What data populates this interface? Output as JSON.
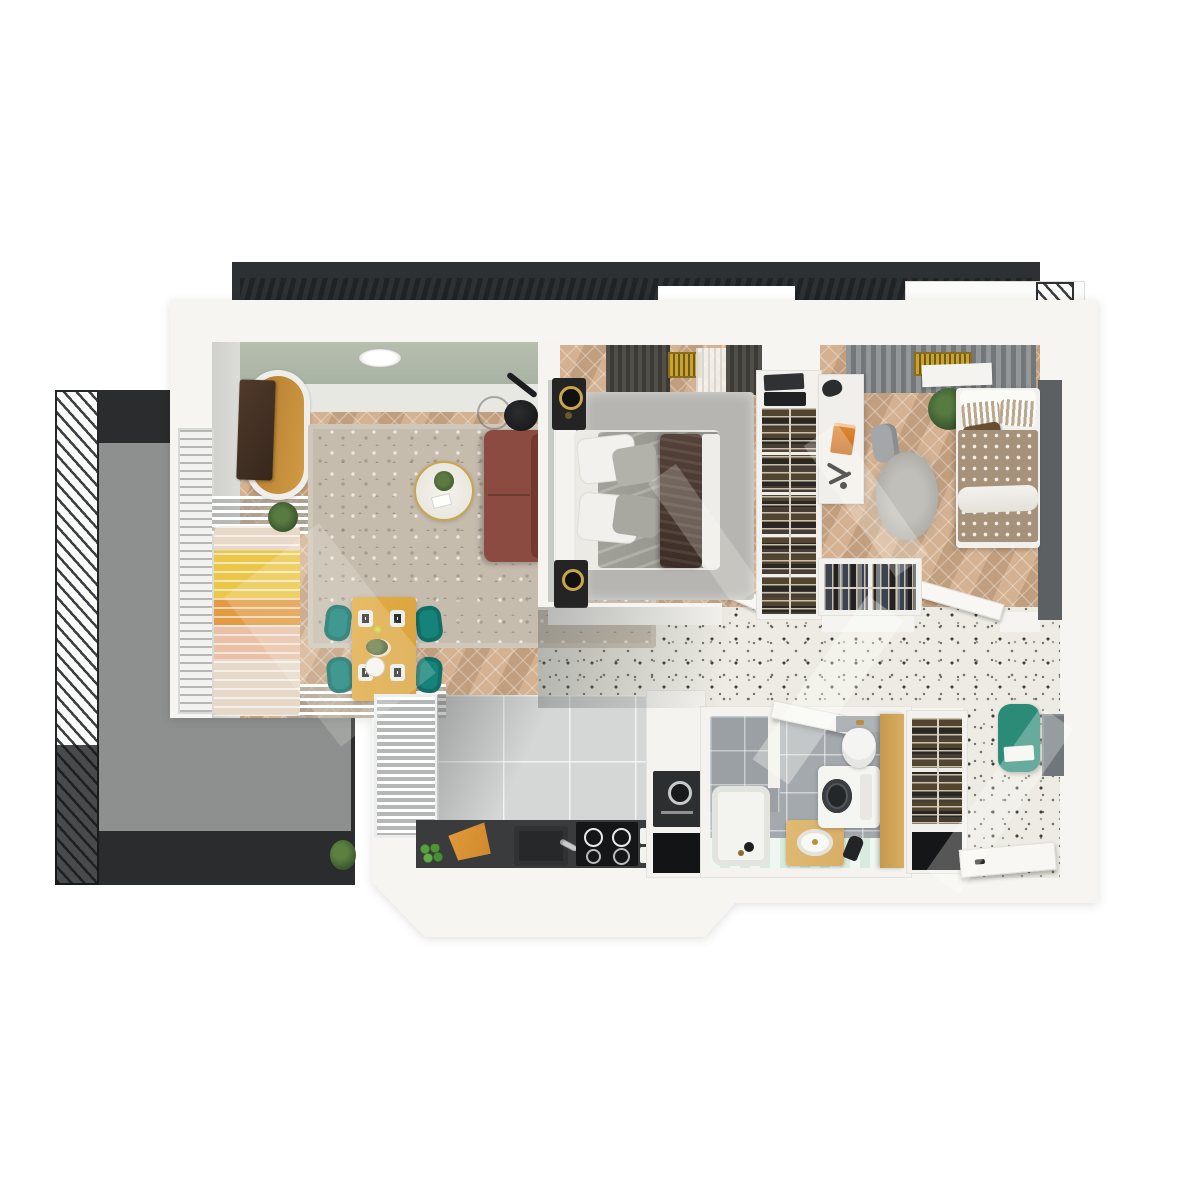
{
  "meta": {
    "title": "Top-down 3D apartment floor plan render",
    "view": "bird's-eye axonometric",
    "style": "photorealistic architectural visualization, no text labels"
  },
  "palette": {
    "paper": "#ffffff",
    "slabWhite": "#f6f5f2",
    "pergola": "#2d3134",
    "pergolaSlat": "#1f2326",
    "railWhite": "#fbfbfa",
    "railLine": "#3a3e40",
    "balconyDark": "#2a2c2d",
    "balconySlab": "#8e908f",
    "greenWall": "#a9b3a3",
    "wallFace": "#d6d7d3",
    "woodA": "#d3b191",
    "woodB": "#c19e7d",
    "rugBeige": "#c6bcae",
    "sofa": "#8c4b41",
    "sofaDark": "#73392f",
    "tableWood": "#d9a33f",
    "chairTeal": "#16837a",
    "gold": "#c9a54b",
    "lampBlack": "#1c1d1e",
    "plantGreen": "#4f6b3e",
    "bedRugGray": "#b6b5b1",
    "mattress": "#eceae5",
    "beddingGray": "#98978f",
    "throwBrown": "#4e3b32",
    "nightBlack": "#242424",
    "curtainA": "#504f49",
    "curtainB": "#3b3a35",
    "radiatorYellow": "#e5bf41",
    "wardrobeFrame": "#f2f1ed",
    "wardrobeDark": "#27221d",
    "deskWhite": "#f0efeb",
    "chairGray": "#a4a7a9",
    "duvetTaupe": "#a6917b",
    "duvetDot": "#f3ece1",
    "cushionBrown": "#5f482c",
    "accentDarkWall": "#5c6063",
    "terrazzoBase": "#edebe3",
    "speckDark": "#3e403a",
    "tileGray": "#d5d6d6",
    "counterDark": "#3a3b3d",
    "hobBlack": "#141618",
    "boardOrange": "#d08a2e",
    "appleGreen": "#55a238",
    "steel": "#c8cbcd",
    "ovenDark": "#2c2e30",
    "bathTile": "#a3a9ad",
    "bathFloorA": "#eef7f0",
    "bathFloorB": "#d9ebdd",
    "vanityWood": "#d8ae65",
    "cabinetYellow": "#d8ad62",
    "benchTeal": "#2b8b77",
    "mirrorGray": "#70767a",
    "doorWhite": "#f8f7f4"
  },
  "rooms": [
    {
      "id": "living-room",
      "label": "Living room",
      "floor": "herringbone oak",
      "furniture": [
        "wood-and-white TV sideboard",
        "wall TV panel",
        "arc floor lamp with glass globe",
        "terracotta two-seat sofa",
        "round white coffee table with plant",
        "mottled beige area rug",
        "window daybed with yellow-orange striped blanket",
        "potted plant",
        "round ceiling light",
        "slatted white radiator benches",
        "sage green feature wall"
      ]
    },
    {
      "id": "dining-area",
      "label": "Dining area",
      "furniture": [
        "rectangular wooden dining table",
        "four teal chairs",
        "two place settings per side",
        "carafe",
        "flower centerpiece",
        "round serving plate"
      ]
    },
    {
      "id": "master-bedroom",
      "label": "Master bedroom",
      "furniture": [
        "double bed with gray bedding and dark brown throw",
        "white pillows",
        "light gray rug",
        "two black nightstand speakers with brass rings",
        "dark pleated curtains",
        "yellow striped radiator",
        "sheer curtain",
        "open white door"
      ]
    },
    {
      "id": "kids-bedroom",
      "label": "Second bedroom",
      "furniture": [
        "single bed with dotted taupe duvet",
        "striped pillows",
        "brown cushion",
        "white desk",
        "orange book",
        "black task lamp",
        "headphones",
        "gray desk chair",
        "round gray rug",
        "potted plant",
        "gray slatted blinds",
        "white wall shelf",
        "open white door"
      ]
    },
    {
      "id": "wardrobe",
      "label": "Walk-in wardrobe",
      "furniture": [
        "tall open wardrobe with five hanger sections",
        "storage boxes on top",
        "second low wardrobe with hanging clothes"
      ]
    },
    {
      "id": "kitchen",
      "label": "Kitchen",
      "furniture": [
        "charcoal worktop",
        "double sink with chrome tap",
        "four-zone induction hob",
        "orange cutting board",
        "green apples",
        "white slatted tall shelving",
        "tall oven housing with built-in oven",
        "black open niche",
        "light gray floor tiles"
      ]
    },
    {
      "id": "bathroom",
      "label": "Bathroom",
      "furniture": [
        "walk-in shower with gray tiling",
        "white tub tray",
        "wooden vanity with oval basin",
        "hairdryer",
        "washing machine",
        "wall-hung toilet with gray cistern wall",
        "tall mustard cabinet",
        "mint striped floor",
        "open white door"
      ]
    },
    {
      "id": "hallway",
      "label": "Entrance hall",
      "furniture": [
        "terrazzo speckled floor",
        "teal upholstered bench",
        "wall mirror",
        "hall closet with hangers and black shoe niche",
        "open white entrance door"
      ]
    },
    {
      "id": "balcony",
      "label": "Balcony",
      "furniture": [
        "diagonal-slat white railing",
        "dark composite decking",
        "gray concrete slab",
        "potted plant"
      ]
    }
  ],
  "exterior": {
    "pergola": {
      "label": "Dark slatted roof band of neighbouring unit"
    },
    "upper_balcony": {
      "label": "Upper balcony slab with diagonal-slat railing"
    }
  }
}
